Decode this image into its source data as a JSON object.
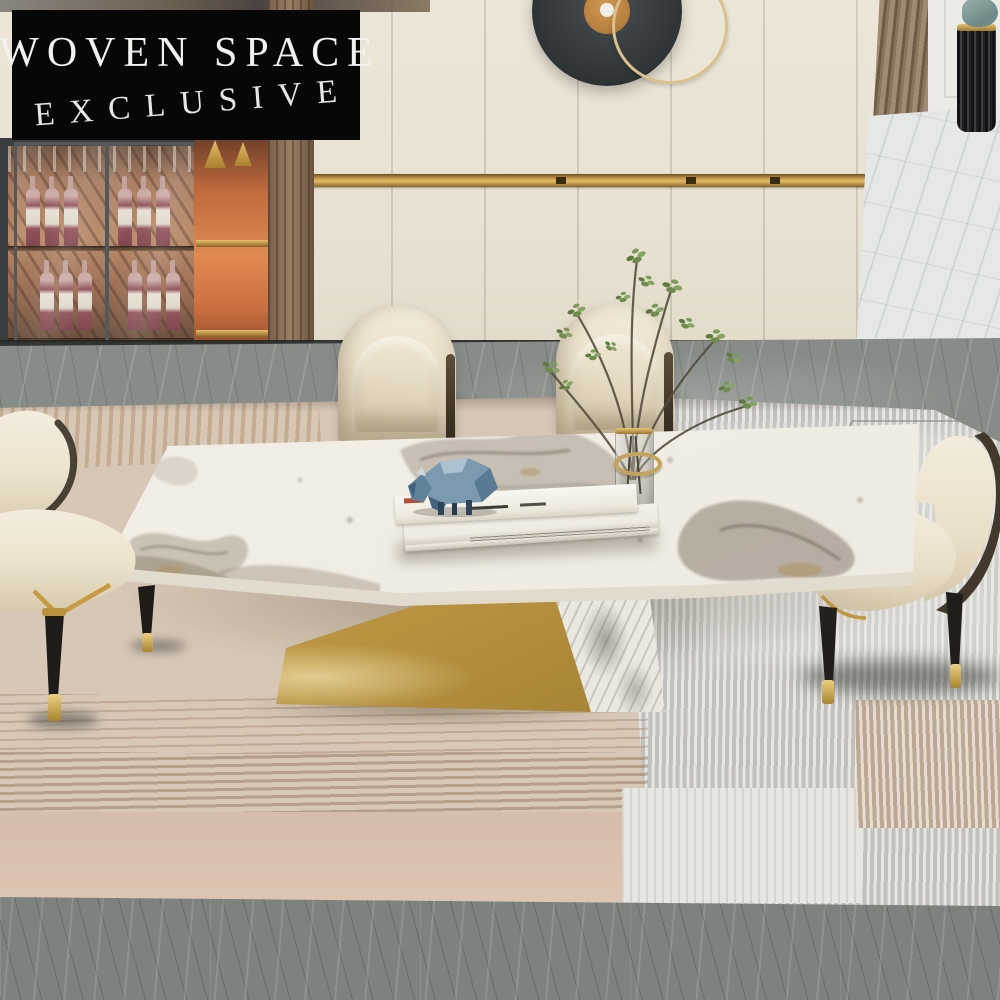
{
  "badge": {
    "line1": "WOVEN SPACE",
    "line2": "EXCLUSIVE"
  },
  "palette": {
    "badge_bg": "#070707",
    "badge_text": "#f3f2ee",
    "wall_cream": "#e9e2d4",
    "gold_accent": "#c99c4f",
    "niche_orange": "#e08a52",
    "wood_brown": "#8a7460",
    "grey_marble_floor": "#888c89",
    "white_marble_floor": "#e6e8e7",
    "rug_beige": "#d7c7b6",
    "rug_pink": "#d6bdab",
    "rug_grey": "#cecdc9",
    "table_marble_white": "#f3f0ea",
    "table_vein_taupe": "#9a8d7c",
    "chair_cream": "#ece4d1",
    "chair_dark_shell": "#3f372c",
    "chair_leg_black": "#1e1b19",
    "plant_green": "#6e8a4d",
    "sculpture_blue": "#7b99af"
  },
  "objects": [
    "exclusive-badge",
    "wall-cabinets",
    "gold-trim",
    "disc-wall-art",
    "gold-ring-decor",
    "wine-display-cabinet",
    "backlit-niche",
    "wood-slat-column",
    "black-fluted-vase",
    "marble-dining-table",
    "gold-z-base",
    "dining-chairs",
    "glass-vase-with-branches",
    "white-books",
    "faceted-bull-figurine",
    "layered-area-rug",
    "grey-marble-floor"
  ]
}
